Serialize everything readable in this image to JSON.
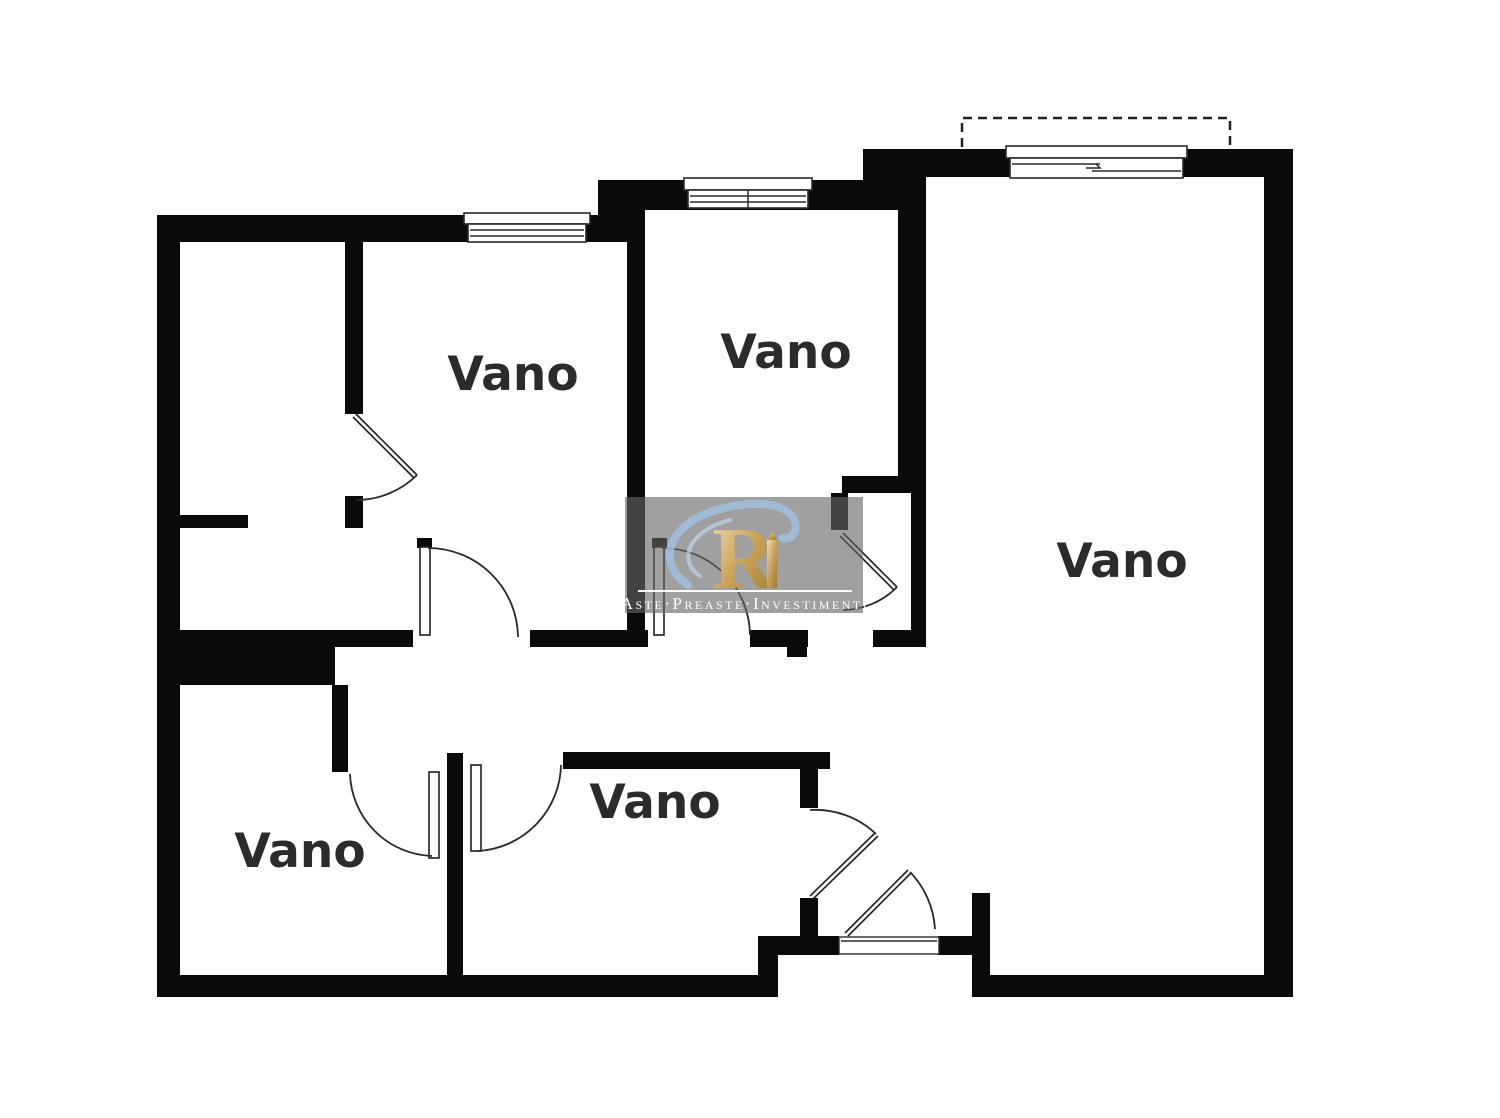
{
  "page": {
    "background_color": "#ffffff",
    "content_type": "apartment floor plan"
  },
  "floor_plan": {
    "wall_color": "#0a0a0a",
    "line_color": "#2a2a2a",
    "label_color": "#2b2b2b",
    "rooms": [
      {
        "label": "Vano"
      },
      {
        "label": "Vano"
      },
      {
        "label": "Vano"
      },
      {
        "label": "Vano"
      },
      {
        "label": "Vano"
      }
    ],
    "features": {
      "windows": 3,
      "door_swings": 8,
      "balcony_outline": "dashed"
    }
  },
  "watermark": {
    "text": "Aste·Preaste·Investimenti",
    "logo": "ri-monogram-icon",
    "panel_color": "#666666",
    "gold_color": "#c9a55a",
    "gold_light": "#f0ddae",
    "gold_dark": "#9c7a35",
    "swirl_color": "#9fc2e2",
    "text_color": "#ffffff"
  }
}
